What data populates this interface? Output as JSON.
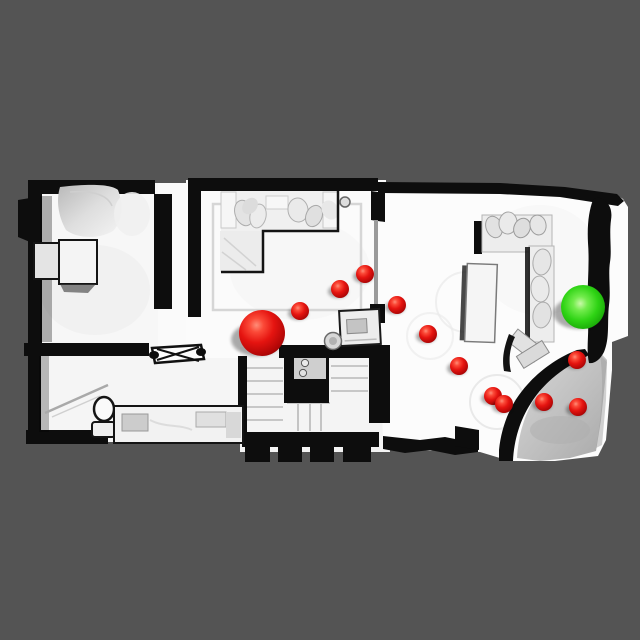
{
  "scene": {
    "kind": "top-down-3d-floorplan-navigation-render",
    "background_color": "#545454",
    "floor_color": "#fafafa",
    "wall_color": "#0d0d0d",
    "slope_color": "#c2c2c2",
    "waypoint_color": "#e51410",
    "goal_color": "#2ed314",
    "start": {
      "x": 262,
      "y": 333,
      "r": 23
    },
    "goal": {
      "x": 583,
      "y": 307,
      "r": 22
    },
    "waypoints": [
      {
        "x": 300,
        "y": 311,
        "r": 9
      },
      {
        "x": 340,
        "y": 289,
        "r": 9
      },
      {
        "x": 365,
        "y": 274,
        "r": 9
      },
      {
        "x": 397,
        "y": 305,
        "r": 9
      },
      {
        "x": 428,
        "y": 334,
        "r": 9
      },
      {
        "x": 459,
        "y": 366,
        "r": 9
      },
      {
        "x": 493,
        "y": 396,
        "r": 9
      },
      {
        "x": 504,
        "y": 404,
        "r": 9
      },
      {
        "x": 544,
        "y": 402,
        "r": 9
      },
      {
        "x": 578,
        "y": 407,
        "r": 9
      },
      {
        "x": 577,
        "y": 360,
        "r": 9
      }
    ]
  }
}
